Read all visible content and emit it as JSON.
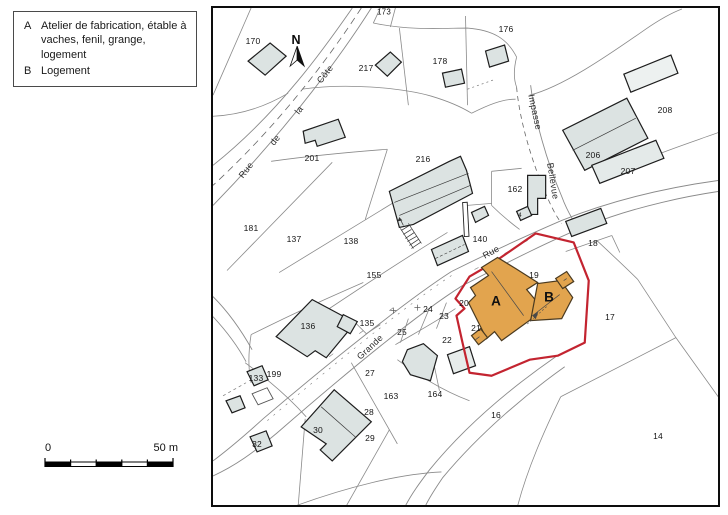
{
  "legend": {
    "items": [
      {
        "key": "A",
        "text": "Atelier de fabrication, étable à vaches, fenil, grange, logement"
      },
      {
        "key": "B",
        "text": "Logement"
      }
    ]
  },
  "north": {
    "label": "N"
  },
  "scale_bar": {
    "start": "0",
    "end": "50 m"
  },
  "colors": {
    "highlight_fill": "#E2A44E",
    "boundary_red": "#C32430",
    "building_fill": "#DCE3E2",
    "building_fill_light": "#EDF1F0",
    "parcel_line": "#8A8A8A",
    "building_stroke": "#1D1D1D"
  },
  "map": {
    "highlighted_buildings": [
      {
        "label": "A",
        "x": 497,
        "y": 302
      },
      {
        "label": "B",
        "x": 550,
        "y": 298
      }
    ],
    "street_labels": [
      {
        "text": "Rue",
        "x": 247,
        "y": 171,
        "rot": -52
      },
      {
        "text": "de",
        "x": 276,
        "y": 141,
        "rot": -52
      },
      {
        "text": "la",
        "x": 300,
        "y": 111,
        "rot": -52
      },
      {
        "text": "Côte",
        "x": 326,
        "y": 75,
        "rot": -52
      },
      {
        "text": "Grande",
        "x": 371,
        "y": 348,
        "rot": -43
      },
      {
        "text": "Rue",
        "x": 492,
        "y": 253,
        "rot": -29
      },
      {
        "text": "Impasse",
        "x": 536,
        "y": 113,
        "rot": 78
      },
      {
        "text": "Bellevue",
        "x": 554,
        "y": 182,
        "rot": 81
      }
    ],
    "parcel_labels": [
      {
        "id": "173",
        "x": 385,
        "y": 13,
        "fs": 8
      },
      {
        "id": "170",
        "x": 254,
        "y": 42
      },
      {
        "id": "217",
        "x": 367,
        "y": 69
      },
      {
        "id": "178",
        "x": 441,
        "y": 62
      },
      {
        "id": "176",
        "x": 507,
        "y": 30
      },
      {
        "id": "201",
        "x": 313,
        "y": 159
      },
      {
        "id": "216",
        "x": 424,
        "y": 160
      },
      {
        "id": "208",
        "x": 666,
        "y": 111
      },
      {
        "id": "206",
        "x": 594,
        "y": 156
      },
      {
        "id": "207",
        "x": 629,
        "y": 172
      },
      {
        "id": "162",
        "x": 516,
        "y": 190
      },
      {
        "id": "181",
        "x": 252,
        "y": 229
      },
      {
        "id": "137",
        "x": 295,
        "y": 240
      },
      {
        "id": "138",
        "x": 352,
        "y": 242
      },
      {
        "id": "155",
        "x": 375,
        "y": 276
      },
      {
        "id": "140",
        "x": 481,
        "y": 240
      },
      {
        "id": "18",
        "x": 594,
        "y": 244
      },
      {
        "id": "19",
        "x": 535,
        "y": 276
      },
      {
        "id": "20",
        "x": 465,
        "y": 304
      },
      {
        "id": "21",
        "x": 477,
        "y": 329
      },
      {
        "id": "22",
        "x": 448,
        "y": 341
      },
      {
        "id": "23",
        "x": 445,
        "y": 317
      },
      {
        "id": "24",
        "x": 429,
        "y": 310
      },
      {
        "id": "25",
        "x": 403,
        "y": 333
      },
      {
        "id": "27",
        "x": 371,
        "y": 374
      },
      {
        "id": "28",
        "x": 370,
        "y": 413
      },
      {
        "id": "29",
        "x": 371,
        "y": 439
      },
      {
        "id": "30",
        "x": 319,
        "y": 431
      },
      {
        "id": "32",
        "x": 258,
        "y": 445
      },
      {
        "id": "133",
        "x": 257,
        "y": 379
      },
      {
        "id": "135",
        "x": 368,
        "y": 324
      },
      {
        "id": "136",
        "x": 309,
        "y": 327
      },
      {
        "id": "199",
        "x": 275,
        "y": 375
      },
      {
        "id": "163",
        "x": 392,
        "y": 397
      },
      {
        "id": "164",
        "x": 436,
        "y": 395
      },
      {
        "id": "16",
        "x": 497,
        "y": 416
      },
      {
        "id": "17",
        "x": 611,
        "y": 318
      },
      {
        "id": "14",
        "x": 659,
        "y": 437
      },
      {
        "id": "4",
        "x": 521,
        "y": 217,
        "fs": 6
      }
    ]
  }
}
